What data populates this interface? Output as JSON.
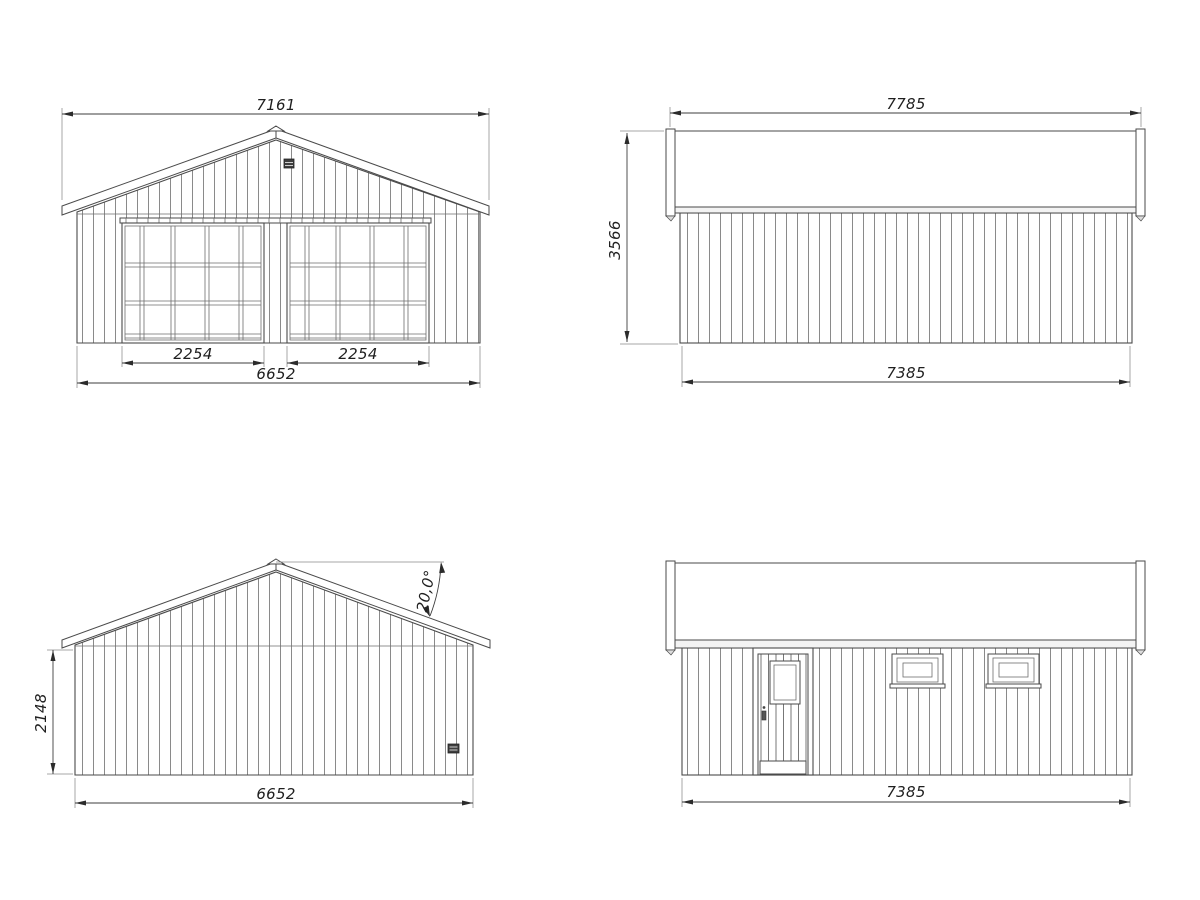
{
  "colors": {
    "background": "#ffffff",
    "line": "#4a4a4a",
    "siding": "#8a8a8a",
    "dimension": "#3d3d3d",
    "text": "#1f1f1f",
    "vent": "#3f3f3f"
  },
  "views": {
    "front": {
      "dims": {
        "roof_width": "7161",
        "left_door_width": "2254",
        "right_door_width": "2254",
        "wall_width": "6652"
      }
    },
    "right_side": {
      "dims": {
        "roof_length": "7785",
        "overall_height": "3566",
        "wall_length": "7385"
      }
    },
    "rear": {
      "dims": {
        "roof_angle": "20,0°",
        "eave_height": "2148",
        "wall_width": "6652"
      }
    },
    "left_side": {
      "dims": {
        "wall_length": "7385"
      }
    }
  }
}
